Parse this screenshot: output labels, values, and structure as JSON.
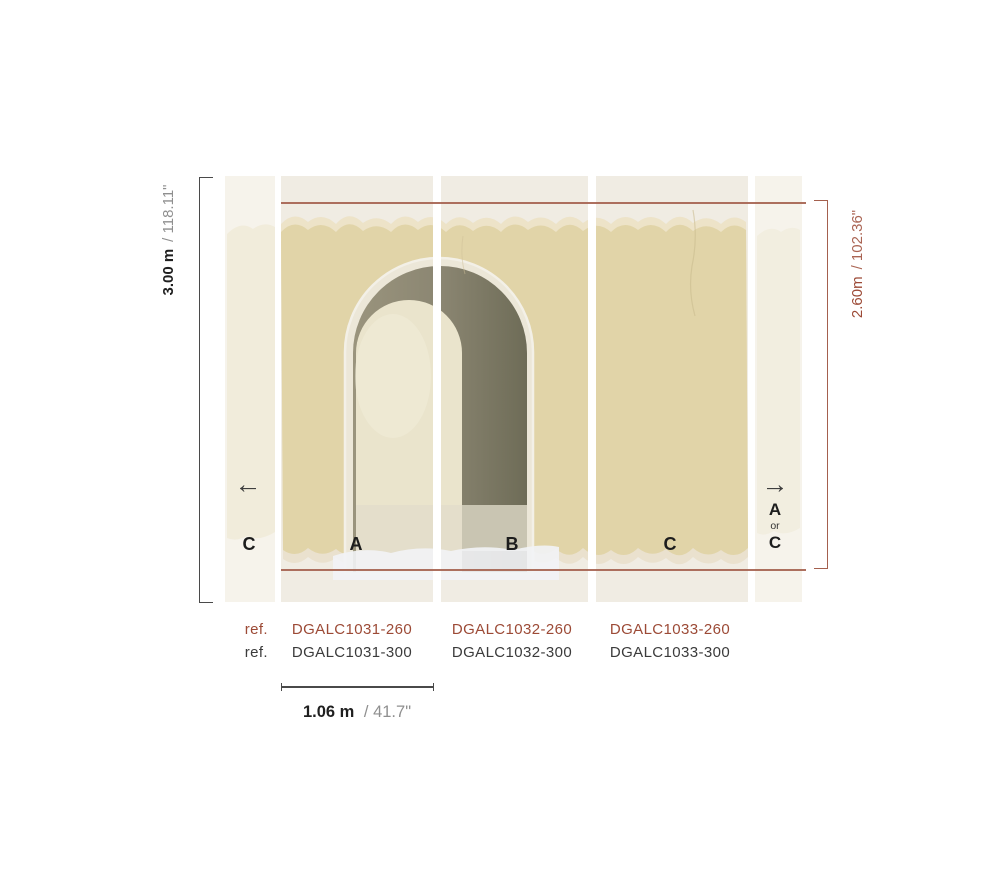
{
  "measurements": {
    "total_height_metric": "3.00 m",
    "total_height_imperial": "/ 118.11\"",
    "variant_height_metric": "2.60m",
    "variant_height_imperial": "/ 102.36\"",
    "panel_width_metric": "1.06 m",
    "panel_width_imperial": "/ 41.7\""
  },
  "panels": {
    "left_partial_label": "C",
    "a_label": "A",
    "b_label": "B",
    "c_label": "C",
    "right_option_top": "A",
    "right_option_middle": "or",
    "right_option_bottom": "C"
  },
  "arrows": {
    "left": "←",
    "right": "→"
  },
  "references": {
    "row_260_label": "ref.",
    "row_300_label": "ref.",
    "columns": [
      {
        "code_260": "DGALC1031-260",
        "code_300": "DGALC1031-300"
      },
      {
        "code_260": "DGALC1032-260",
        "code_300": "DGALC1032-300"
      },
      {
        "code_260": "DGALC1033-260",
        "code_300": "DGALC1033-300"
      }
    ]
  },
  "colors": {
    "accent_red_text": "#9c4a36",
    "measure_red_line": "#a4604e",
    "measure_black_line": "#4a4a4a",
    "wall_beige": "#e1d4a8",
    "arch_frame": "#ece7d8",
    "arch_shadow_dark": "#6e6c57",
    "arch_shadow_light": "#9a947d",
    "arch_opening": "#eae4cc",
    "strip_cream": "#f6f3eb",
    "panel_background": "#f0ece3",
    "text_dark": "#1f1f1f",
    "text_gray": "#8f8f8f"
  }
}
